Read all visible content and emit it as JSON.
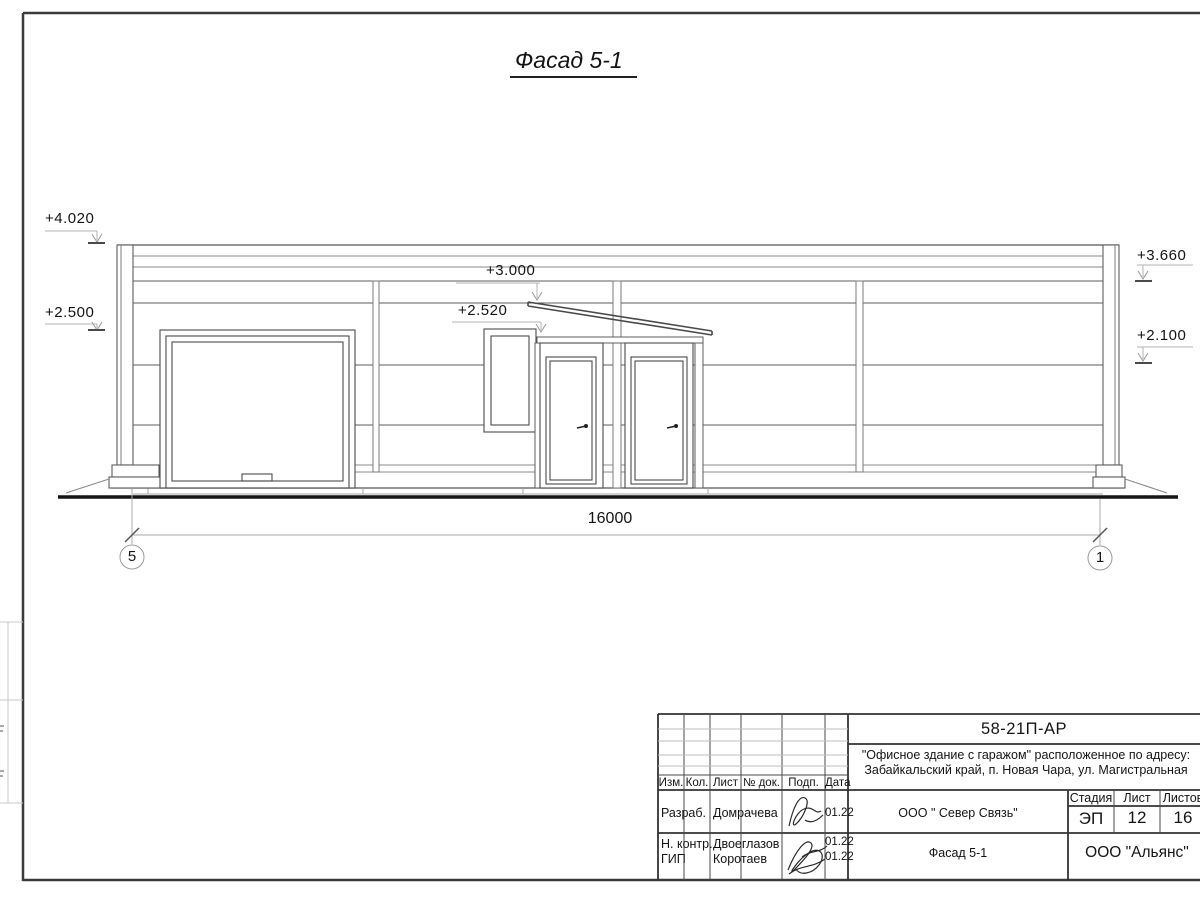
{
  "drawing": {
    "view_title": "Фасад 5-1",
    "levels": {
      "left_top": "+4.020",
      "left_mid": "+2.500",
      "center_top": "+3.000",
      "center_mid": "+2.520",
      "right_top": "+3.660",
      "right_mid": "+2.100"
    },
    "dimension_total": "16000",
    "axes": {
      "left": "5",
      "right": "1"
    }
  },
  "title_block": {
    "doc_code": "58-21П-АР",
    "project_line1": "\"Офисное здание с гаражом\" расположенное по адресу:",
    "project_line2": "Забайкальский край, п. Новая Чара, ул. Магистральная",
    "client": "ООО \" Север Связь\"",
    "sheet_title": "Фасад 5-1",
    "company": "ООО \"Альянс\"",
    "columns": {
      "izm": "Изм.",
      "kol": "Кол.",
      "list": "Лист",
      "doc": "№ док.",
      "sign": "Подп.",
      "date": "Дата"
    },
    "stage_label": "Стадия",
    "sheet_label": "Лист",
    "sheets_label": "Листов",
    "stage": "ЭП",
    "sheet_no": "12",
    "sheets_total": "16",
    "rows": [
      {
        "role": "Разраб.",
        "name": "Домрачева",
        "date": "01.22"
      },
      {
        "role": "Н. контр.",
        "name": "Двоеглазов",
        "date": "01.22"
      },
      {
        "role": "ГИП",
        "name": "Коротаев",
        "date": "01.22"
      }
    ]
  }
}
